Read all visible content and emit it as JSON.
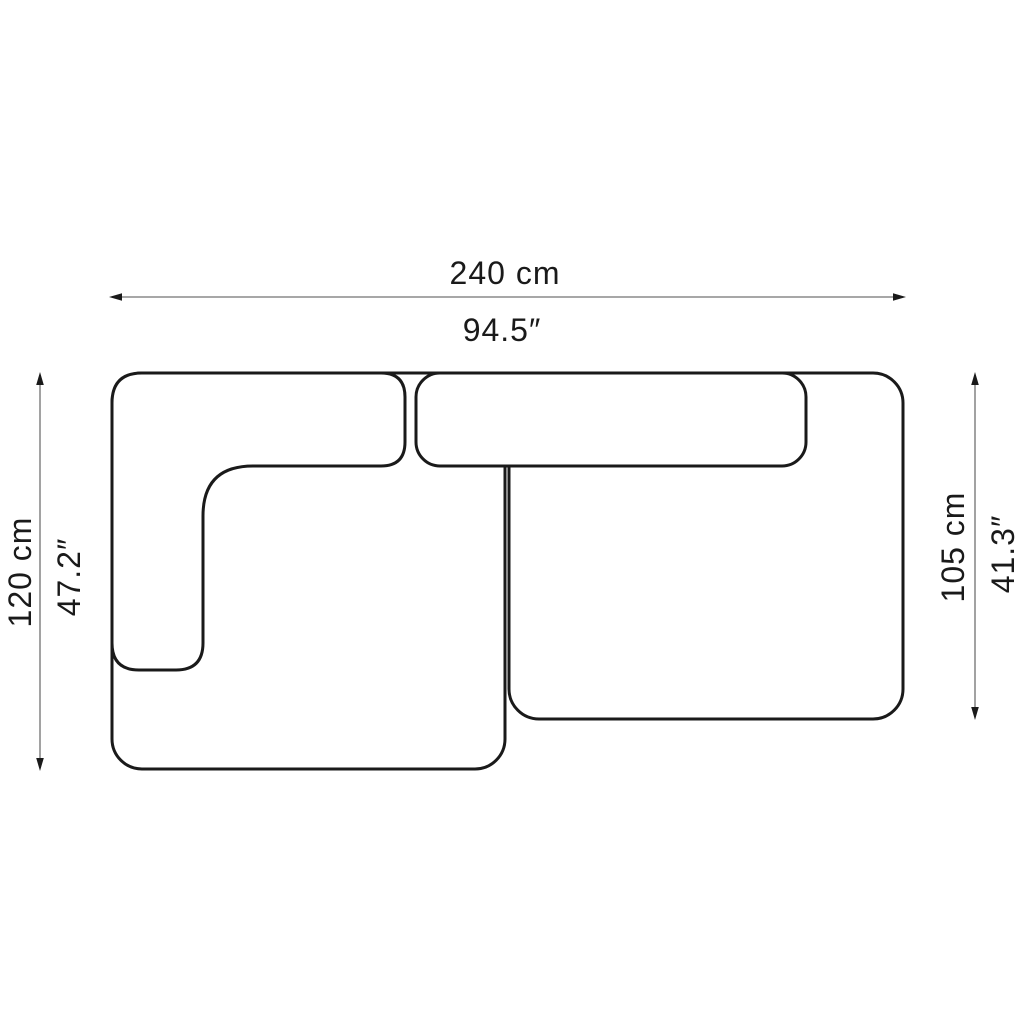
{
  "diagram": {
    "type": "furniture-dimension-drawing",
    "subject": "two-module corner sofa, top view plan",
    "colors": {
      "line": "#1a1a1a",
      "dimension_line": "#8a8a8a",
      "background": "#ffffff"
    },
    "dimensions": {
      "width_cm": "240 cm",
      "width_in": "94.5″",
      "left_depth_cm": "120 cm",
      "left_depth_in": "47.2″",
      "right_depth_cm": "105 cm",
      "right_depth_in": "41.3″"
    }
  }
}
